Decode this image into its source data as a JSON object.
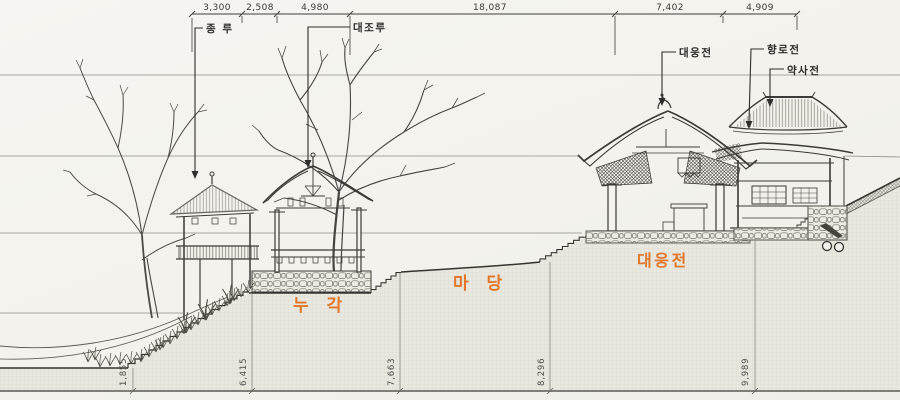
{
  "top_dims": [
    "3,300",
    "2,508",
    "4,980",
    "18,087",
    "7,402",
    "4,909"
  ],
  "buildings": {
    "jongru": "종 루",
    "daejoru": "대조루",
    "daeungjeon": "대웅전",
    "hyangnojeon": "향로전",
    "yaksajeon": "약사전"
  },
  "areas": {
    "nugak": "누 각",
    "madang": "마 당",
    "daeungjeon": "대웅전"
  },
  "levels": [
    "1,855",
    "6,415",
    "7,663",
    "8,296",
    "9,989"
  ],
  "colors": {
    "accent_orange": "#e2762a",
    "line": "#3b3a36",
    "paper": "#f4f3ee",
    "earth_fill": "#e9e8e0"
  }
}
